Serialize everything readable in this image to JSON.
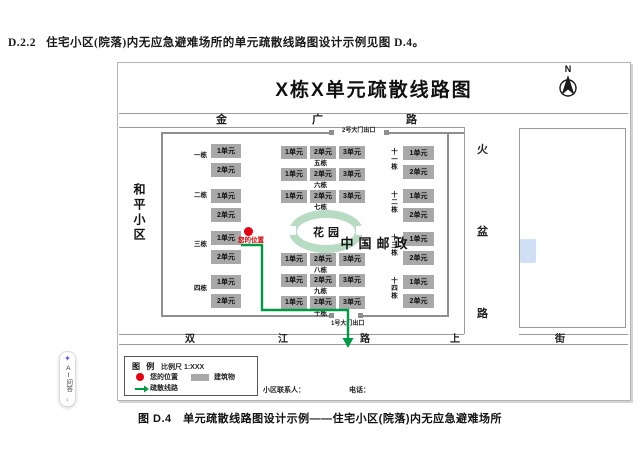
{
  "page": {
    "section_number": "D.2.2",
    "section_text": "住宅小区(院落)内无应急避难场所的单元疏散线路图设计示例见图 D.4。",
    "caption": "图 D.4　单元疏散线路图设计示例——住宅小区(院落)内无应急避难场所"
  },
  "figure": {
    "title": "X栋X单元疏散线路图",
    "north_label": "N",
    "neighborhood_left": "和平小区",
    "roads": {
      "top": [
        "金",
        "广",
        "路"
      ],
      "right": [
        "火",
        "盆",
        "路"
      ],
      "bottom": [
        "双",
        "江",
        "路",
        "上",
        "街"
      ]
    },
    "gates": {
      "north": "2号大门出口",
      "south": "1号大门出口"
    },
    "garden_label": "花园",
    "post_office_label": "中国邮政",
    "your_location_label": "您的位置",
    "buildings": {
      "left": [
        {
          "name": "一栋",
          "units": [
            "1单元",
            "2单元"
          ]
        },
        {
          "name": "二栋",
          "units": [
            "1单元",
            "2单元"
          ]
        },
        {
          "name": "三栋",
          "units": [
            "1单元",
            "2单元"
          ]
        },
        {
          "name": "四栋",
          "units": [
            "1单元",
            "2单元"
          ]
        }
      ],
      "middle": [
        {
          "name": "五栋",
          "units": [
            "1单元",
            "2单元",
            "3单元"
          ]
        },
        {
          "name": "六栋",
          "units": [
            "1单元",
            "2单元",
            "3单元"
          ]
        },
        {
          "name": "七栋",
          "units": [
            "1单元",
            "2单元",
            "3单元"
          ]
        },
        {
          "name": "八栋",
          "units": [
            "1单元",
            "2单元",
            "3单元"
          ]
        },
        {
          "name": "九栋",
          "units": [
            "1单元",
            "2单元",
            "3单元"
          ]
        },
        {
          "name": "十栋",
          "units": [
            "1单元",
            "2单元",
            "3单元"
          ]
        }
      ],
      "right": [
        {
          "name": "十一栋",
          "units": [
            "1单元",
            "2单元"
          ]
        },
        {
          "name": "十二栋",
          "units": [
            "1单元",
            "2单元"
          ]
        },
        {
          "name": "十三栋",
          "units": [
            "1单元",
            "2单元"
          ]
        },
        {
          "name": "十四栋",
          "units": [
            "1单元",
            "2单元"
          ]
        }
      ]
    },
    "legend": {
      "title": "图 例",
      "scale": "比例尺 1:XXX",
      "your_location": "您的位置",
      "building": "建筑物",
      "route": "疏散线路"
    },
    "contact_label": "小区联系人：",
    "phone_label": "电话：",
    "colors": {
      "route_green": "#009a44",
      "building_gray": "#a8a8a8",
      "garden_green": "#b7dcc3",
      "marker_red": "#e60012"
    }
  },
  "ai_widget": {
    "label": "AI问答",
    "collapse_icon": "‹"
  }
}
